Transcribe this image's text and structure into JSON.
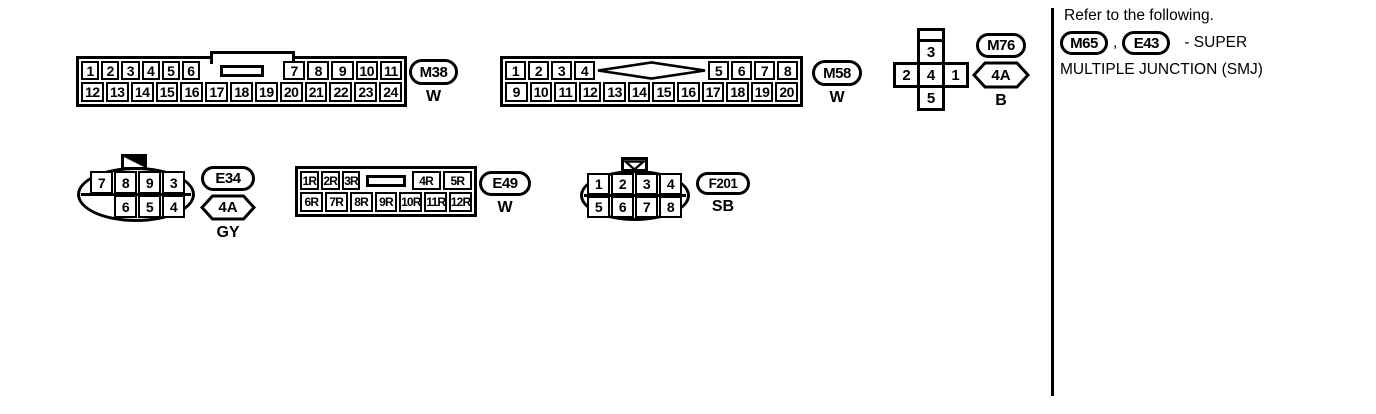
{
  "connectors": {
    "m38": {
      "id": "M38",
      "color": "W",
      "top_left": [
        "1",
        "2",
        "3",
        "4",
        "5",
        "6"
      ],
      "top_right": [
        "7",
        "8",
        "9",
        "10",
        "11"
      ],
      "bottom": [
        "12",
        "13",
        "14",
        "15",
        "16",
        "17",
        "18",
        "19",
        "20",
        "21",
        "22",
        "23",
        "24"
      ]
    },
    "m58": {
      "id": "M58",
      "color": "W",
      "top_left": [
        "1",
        "2",
        "3",
        "4"
      ],
      "top_right": [
        "5",
        "6",
        "7",
        "8"
      ],
      "bottom": [
        "9",
        "10",
        "11",
        "12",
        "13",
        "14",
        "15",
        "16",
        "17",
        "18",
        "19",
        "20"
      ]
    },
    "m76": {
      "id": "M76",
      "code": "4A",
      "color": "B",
      "pin_top": "3",
      "pin_left": "2",
      "pin_center": "4",
      "pin_right": "1",
      "pin_bottom": "5"
    },
    "e34": {
      "id": "E34",
      "code": "4A",
      "color": "GY",
      "top": [
        "7",
        "8",
        "9",
        "3"
      ],
      "bottom": [
        "6",
        "5",
        "4"
      ]
    },
    "e49": {
      "id": "E49",
      "color": "W",
      "top_left": [
        "1R",
        "2R",
        "3R"
      ],
      "top_right": [
        "4R",
        "5R"
      ],
      "bottom": [
        "6R",
        "7R",
        "8R",
        "9R",
        "10R",
        "11R",
        "12R"
      ]
    },
    "f201": {
      "id": "F201",
      "color": "SB",
      "top": [
        "1",
        "2",
        "3",
        "4"
      ],
      "bottom": [
        "5",
        "6",
        "7",
        "8"
      ]
    }
  },
  "note": {
    "line1": "Refer to the following.",
    "ref1": "M65",
    "separator": ",",
    "ref2": "E43",
    "suffix": "- SUPER",
    "line3": "MULTIPLE JUNCTION (SMJ)"
  }
}
